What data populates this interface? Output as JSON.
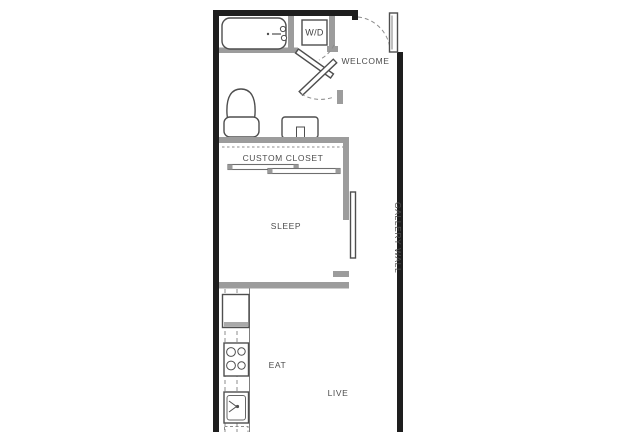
{
  "floorplan": {
    "labels": {
      "welcome": "WELCOME",
      "washer_dryer": "W/D",
      "custom_closet": "CUSTOM CLOSET",
      "sleep": "SLEEP",
      "gallery_wall": "GALLERY WALL",
      "eat": "EAT",
      "live": "LIVE"
    },
    "colors": {
      "outer_wall": "#1e1e1e",
      "inner_wall": "#9c9c9c",
      "fixture_outline": "#4e4e4e",
      "door_outline": "#6e6e6e",
      "label_text": "#4d4d4d",
      "dashed_line": "#8c8c8c",
      "background": "#ffffff"
    },
    "fixtures": [
      "entry-door",
      "bathtub",
      "washer-dryer",
      "toilet",
      "vanity-sink",
      "closet-sliding-doors",
      "bedroom-sliding-door",
      "refrigerator",
      "range-cooktop",
      "kitchen-sink",
      "dishwasher"
    ]
  }
}
